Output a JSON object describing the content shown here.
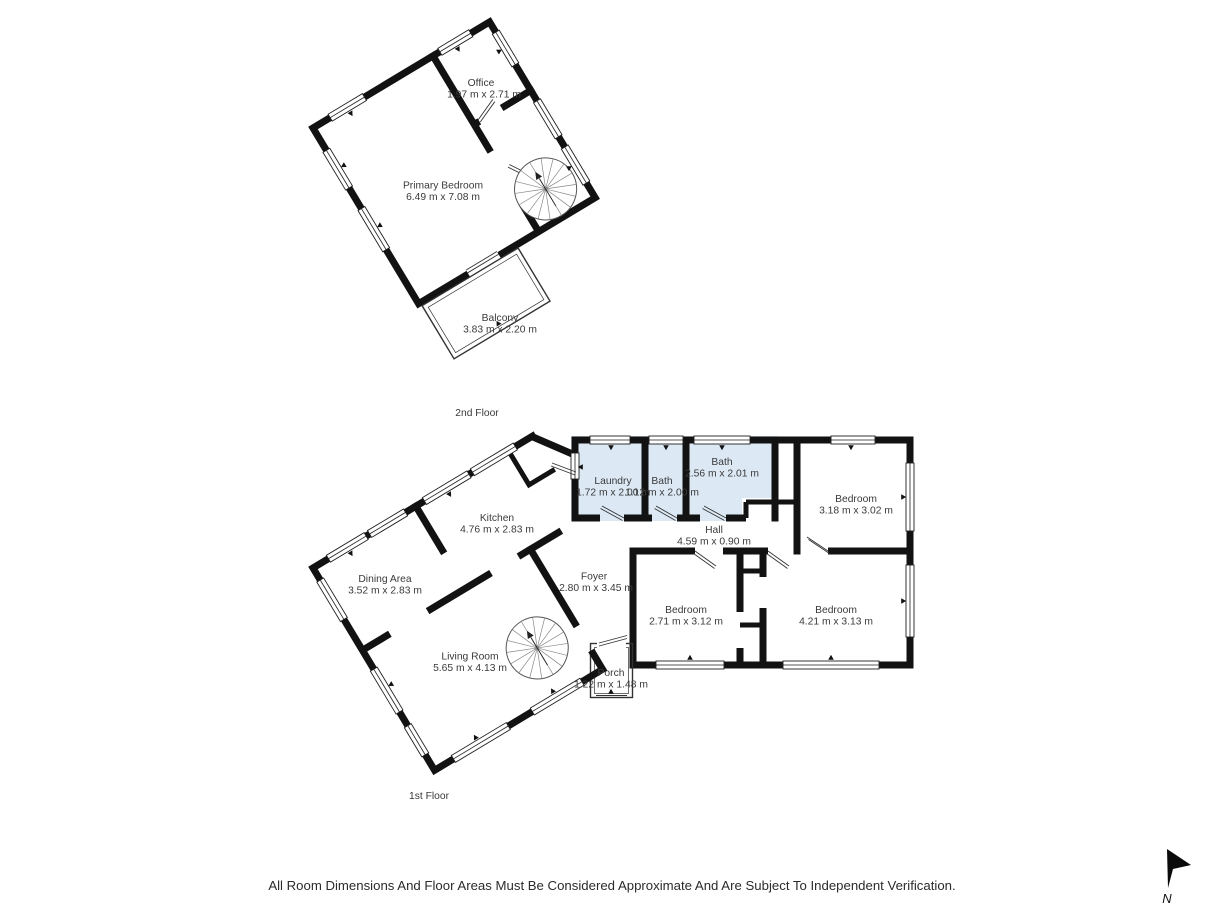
{
  "document": {
    "type": "floor-plan",
    "disclaimer": "All Room Dimensions And Floor Areas Must Be Considered Approximate And Are Subject To Independent Verification."
  },
  "compass": {
    "label": "N"
  },
  "colors": {
    "wall": "#121212",
    "wet_room_fill": "#dce9f5",
    "window_line": "#1f1f1f",
    "text": "#3a3a3a",
    "background": "#ffffff"
  },
  "floors": [
    {
      "label": "2nd Floor",
      "rooms": [
        {
          "id": "office",
          "name": "Office",
          "dims": "1.97 m x 2.71 m"
        },
        {
          "id": "primary-bedroom",
          "name": "Primary Bedroom",
          "dims": "6.49 m x 7.08 m"
        },
        {
          "id": "balcony",
          "name": "Balcony",
          "dims": "3.83 m x 2.20 m"
        }
      ]
    },
    {
      "label": "1st Floor",
      "rooms": [
        {
          "id": "laundry",
          "name": "Laundry",
          "dims": "1.72 m x 2.00 m"
        },
        {
          "id": "bath-small",
          "name": "Bath",
          "dims": "1.12 m x 2.00 m"
        },
        {
          "id": "bath",
          "name": "Bath",
          "dims": "2.56 m x 2.01 m"
        },
        {
          "id": "bedroom-top-right",
          "name": "Bedroom",
          "dims": "3.18 m x 3.02 m"
        },
        {
          "id": "hall",
          "name": "Hall",
          "dims": "4.59 m x 0.90 m"
        },
        {
          "id": "kitchen",
          "name": "Kitchen",
          "dims": "4.76 m x 2.83 m"
        },
        {
          "id": "dining-area",
          "name": "Dining Area",
          "dims": "3.52 m x 2.83 m"
        },
        {
          "id": "foyer",
          "name": "Foyer",
          "dims": "2.80 m x 3.45 m"
        },
        {
          "id": "bedroom-bottom-left",
          "name": "Bedroom",
          "dims": "2.71 m x 3.12 m"
        },
        {
          "id": "bedroom-bottom-right",
          "name": "Bedroom",
          "dims": "4.21 m x 3.13 m"
        },
        {
          "id": "living-room",
          "name": "Living Room",
          "dims": "5.65 m x 4.13 m"
        },
        {
          "id": "porch",
          "name": "Porch",
          "dims": "1.22 m x 1.48 m"
        }
      ]
    }
  ]
}
